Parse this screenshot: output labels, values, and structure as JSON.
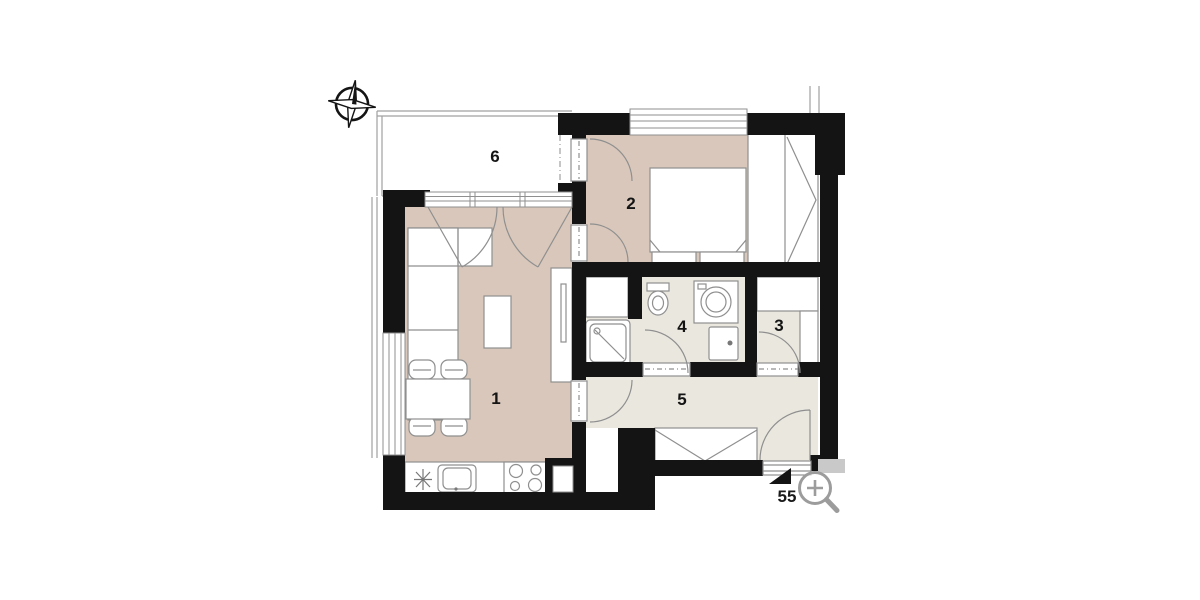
{
  "floorplan": {
    "rooms": [
      {
        "label": "1",
        "name": "living-room-with-kitchen"
      },
      {
        "label": "2",
        "name": "bedroom"
      },
      {
        "label": "3",
        "name": "storage-room"
      },
      {
        "label": "4",
        "name": "bathroom"
      },
      {
        "label": "5",
        "name": "hallway"
      },
      {
        "label": "6",
        "name": "balcony"
      }
    ],
    "unit_label": "55",
    "icons": {
      "compass": "compass-rose-north",
      "zoom": "magnifier-plus",
      "entrance_marker": "solid-triangle"
    },
    "colors": {
      "wall": "#141414",
      "floor_warm": "#d8c7ba",
      "floor_light": "#eae7df",
      "outline": "#8f8f8f",
      "corner_block": "#c9c9c9"
    }
  }
}
